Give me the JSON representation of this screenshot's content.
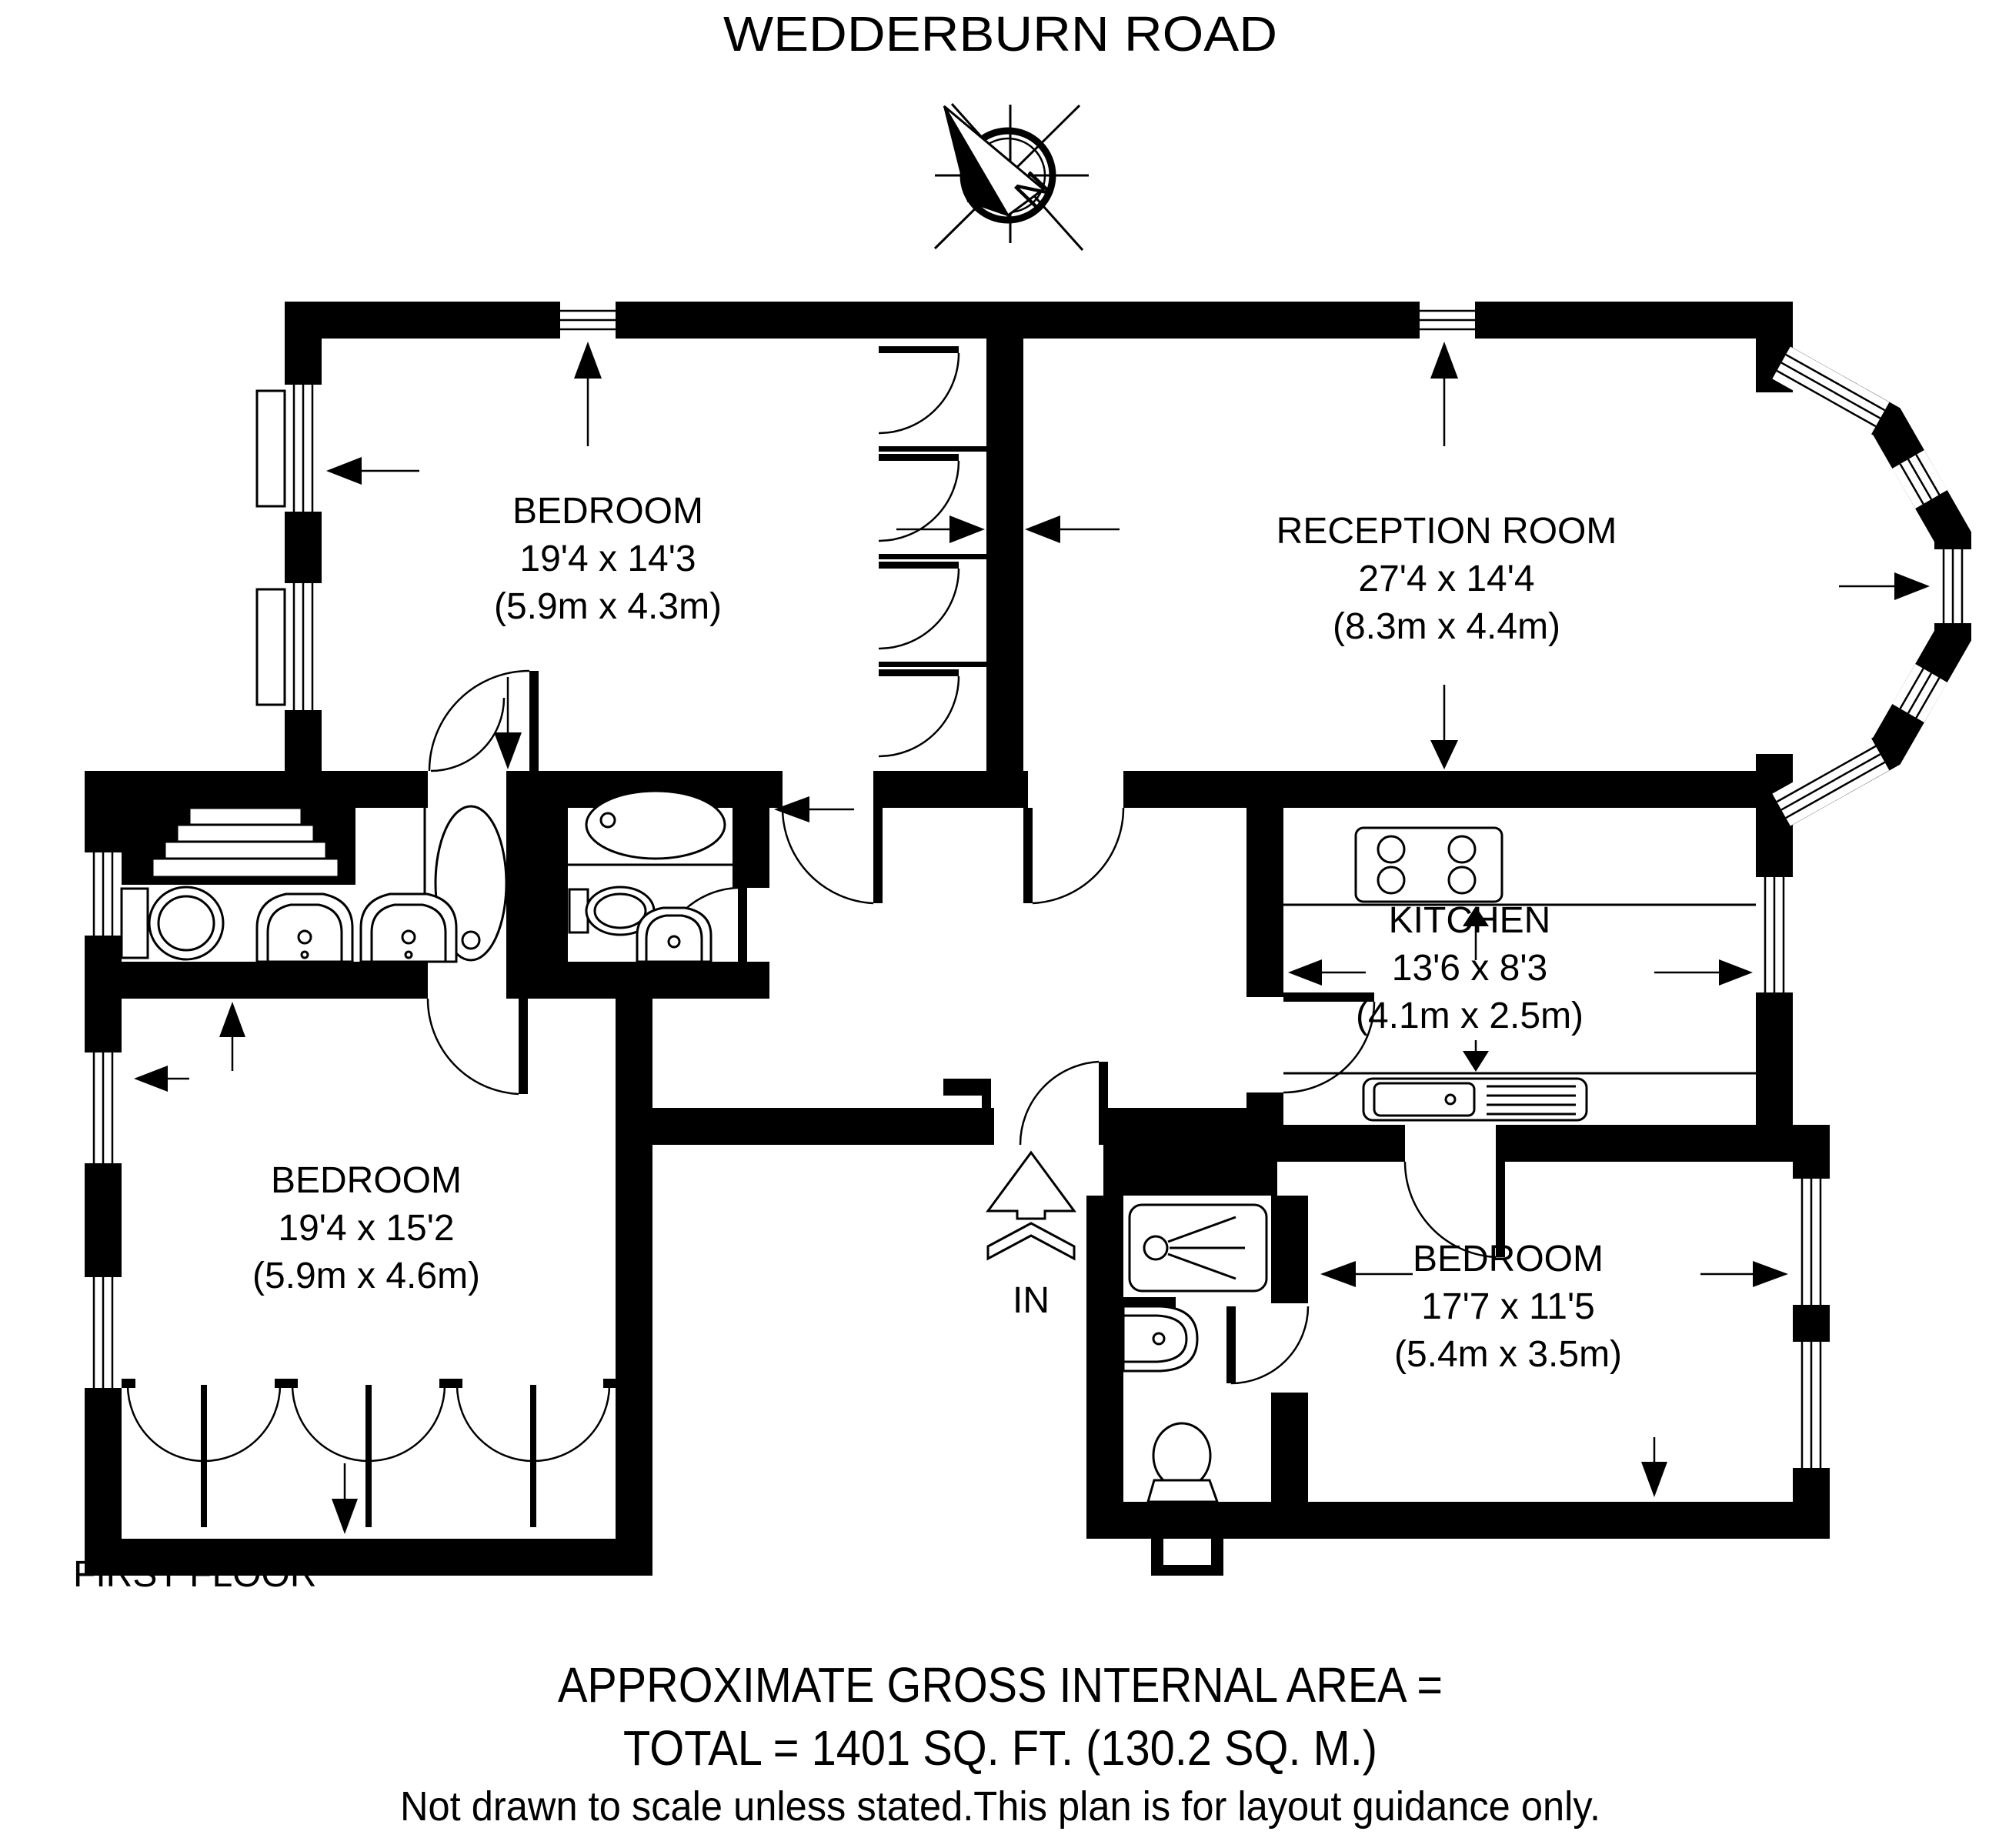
{
  "title": "WEDDERBURN ROAD",
  "compass": {
    "north_label": "N"
  },
  "rooms": {
    "bedroom_top_left": {
      "name": "BEDROOM",
      "size_ft": "19'4 x 14'3",
      "size_m": "(5.9m x 4.3m)"
    },
    "reception_room": {
      "name": "RECEPTION ROOM",
      "size_ft": "27'4 x 14'4",
      "size_m": "(8.3m x 4.4m)"
    },
    "kitchen": {
      "name": "KITCHEN",
      "size_ft": "13'6 x 8'3",
      "size_m": "(4.1m x 2.5m)"
    },
    "bedroom_bottom_left": {
      "name": "BEDROOM",
      "size_ft": "19'4 x 15'2",
      "size_m": "(5.9m x 4.6m)"
    },
    "bedroom_bottom_right": {
      "name": "BEDROOM",
      "size_ft": "17'7 x 11'5",
      "size_m": "(5.4m x 3.5m)"
    }
  },
  "entrance": {
    "label": "IN"
  },
  "floor_label": "FIRST FLOOR",
  "footer": {
    "line1": "APPROXIMATE GROSS INTERNAL AREA =",
    "line2": "TOTAL = 1401 SQ. FT. (130.2 SQ. M.)",
    "line3": "Not drawn to scale unless stated.This plan is for layout guidance only."
  },
  "colors": {
    "walls": "#000000",
    "background": "#ffffff"
  }
}
